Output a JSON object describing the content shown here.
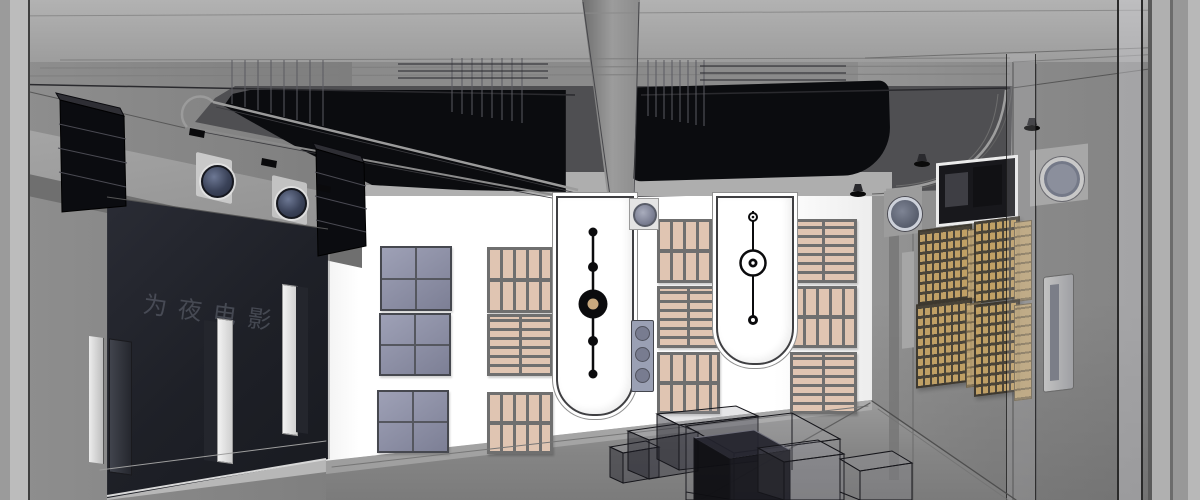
{
  "scene": {
    "title": "Home theater room - 3D X-ray architectural rendering",
    "view": "wide-angle cutaway interior, SketchUp wireframe style",
    "screen_text": "为夜电影音",
    "colors": {
      "white_wall": "#ffffff",
      "left_wall": "#868686",
      "right_wall": "#8b8b8b",
      "floor": "#8a8a8a",
      "cove_dark": "#4f4f52",
      "coffer_black": "#0b0c0f",
      "screen": "#1e2027",
      "screen_text": "#7a7f8c",
      "panel_blue": "#8e91aa",
      "panel_blue_line": "#55575f",
      "wood_slat": "#e0c5b2",
      "wood_frame": "#6f6f6f",
      "diffuser_gold": "#c4a263",
      "diffuser_dark": "#453f33",
      "niche_outline": "#3f3f42",
      "pendulum_black": "#0b0b0d",
      "pendulum_tan": "#c9a87e",
      "speaker_navy": "#3a4258",
      "wireframe": "#16161c"
    },
    "inventory": {
      "ceiling": [
        "recessed black light coffers x2",
        "central beam",
        "wireframe section lines",
        "recessed downlights"
      ],
      "screen_wall": [
        "projection screen with faint brand text",
        "line-array speaker stacks x2",
        "round in-wall speakers x2",
        "floor-standing speaker towers x3"
      ],
      "side_wall": [
        "blue fabric acoustic panels x3",
        "wood slat diffuser panels x9",
        "arched niches with pendulum fixtures x2",
        "in-wall speaker square",
        "speaker column panel"
      ],
      "rear_wall": [
        "projection booth window",
        "round in-wall speakers x2",
        "QRD diffuser grids x4",
        "column speaker",
        "glass partition posts"
      ],
      "floor": [
        "wireframe carpeted steps x3",
        "wireframe media console",
        "wireframe glass cabinets x2"
      ]
    }
  }
}
